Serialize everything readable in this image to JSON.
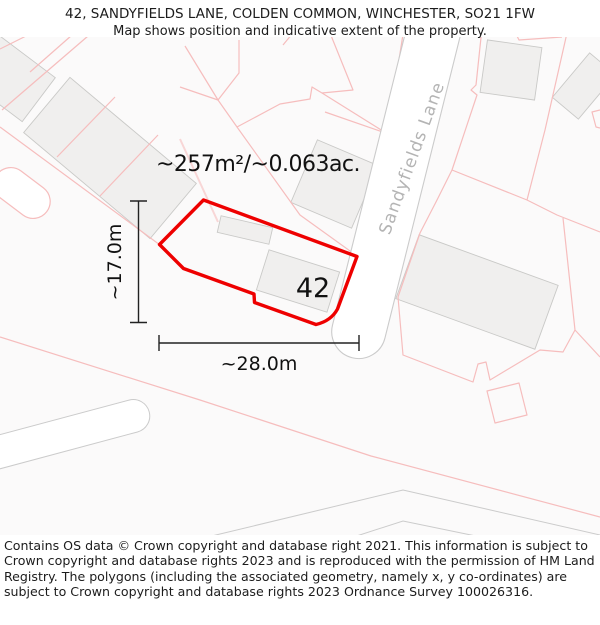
{
  "header": {
    "title": "42, SANDYFIELDS LANE, COLDEN COMMON, WINCHESTER, SO21 1FW",
    "subtitle": "Map shows position and indicative extent of the property."
  },
  "map": {
    "plot_number": "42",
    "area_label": "~257m²/~0.063ac.",
    "width_dimension": "~28.0m",
    "height_dimension": "~17.0m",
    "street_name": "Sandyfields Lane",
    "colors": {
      "property_outline": "#ee0000",
      "parcel_line": "#f6bdbd",
      "parcel_line_pale": "#f8d6d6",
      "building_fill": "#f0efee",
      "building_stroke": "#c9c9c7",
      "road_line": "#cbcbcb",
      "street_text": "#b4b4b4",
      "dimension_line": "#222222"
    }
  },
  "footer": {
    "copyright": "Contains OS data © Crown copyright and database right 2021. This information is subject to Crown copyright and database rights 2023 and is reproduced with the permission of HM Land Registry. The polygons (including the associated geometry, namely x, y co-ordinates) are subject to Crown copyright and database rights 2023 Ordnance Survey 100026316."
  }
}
